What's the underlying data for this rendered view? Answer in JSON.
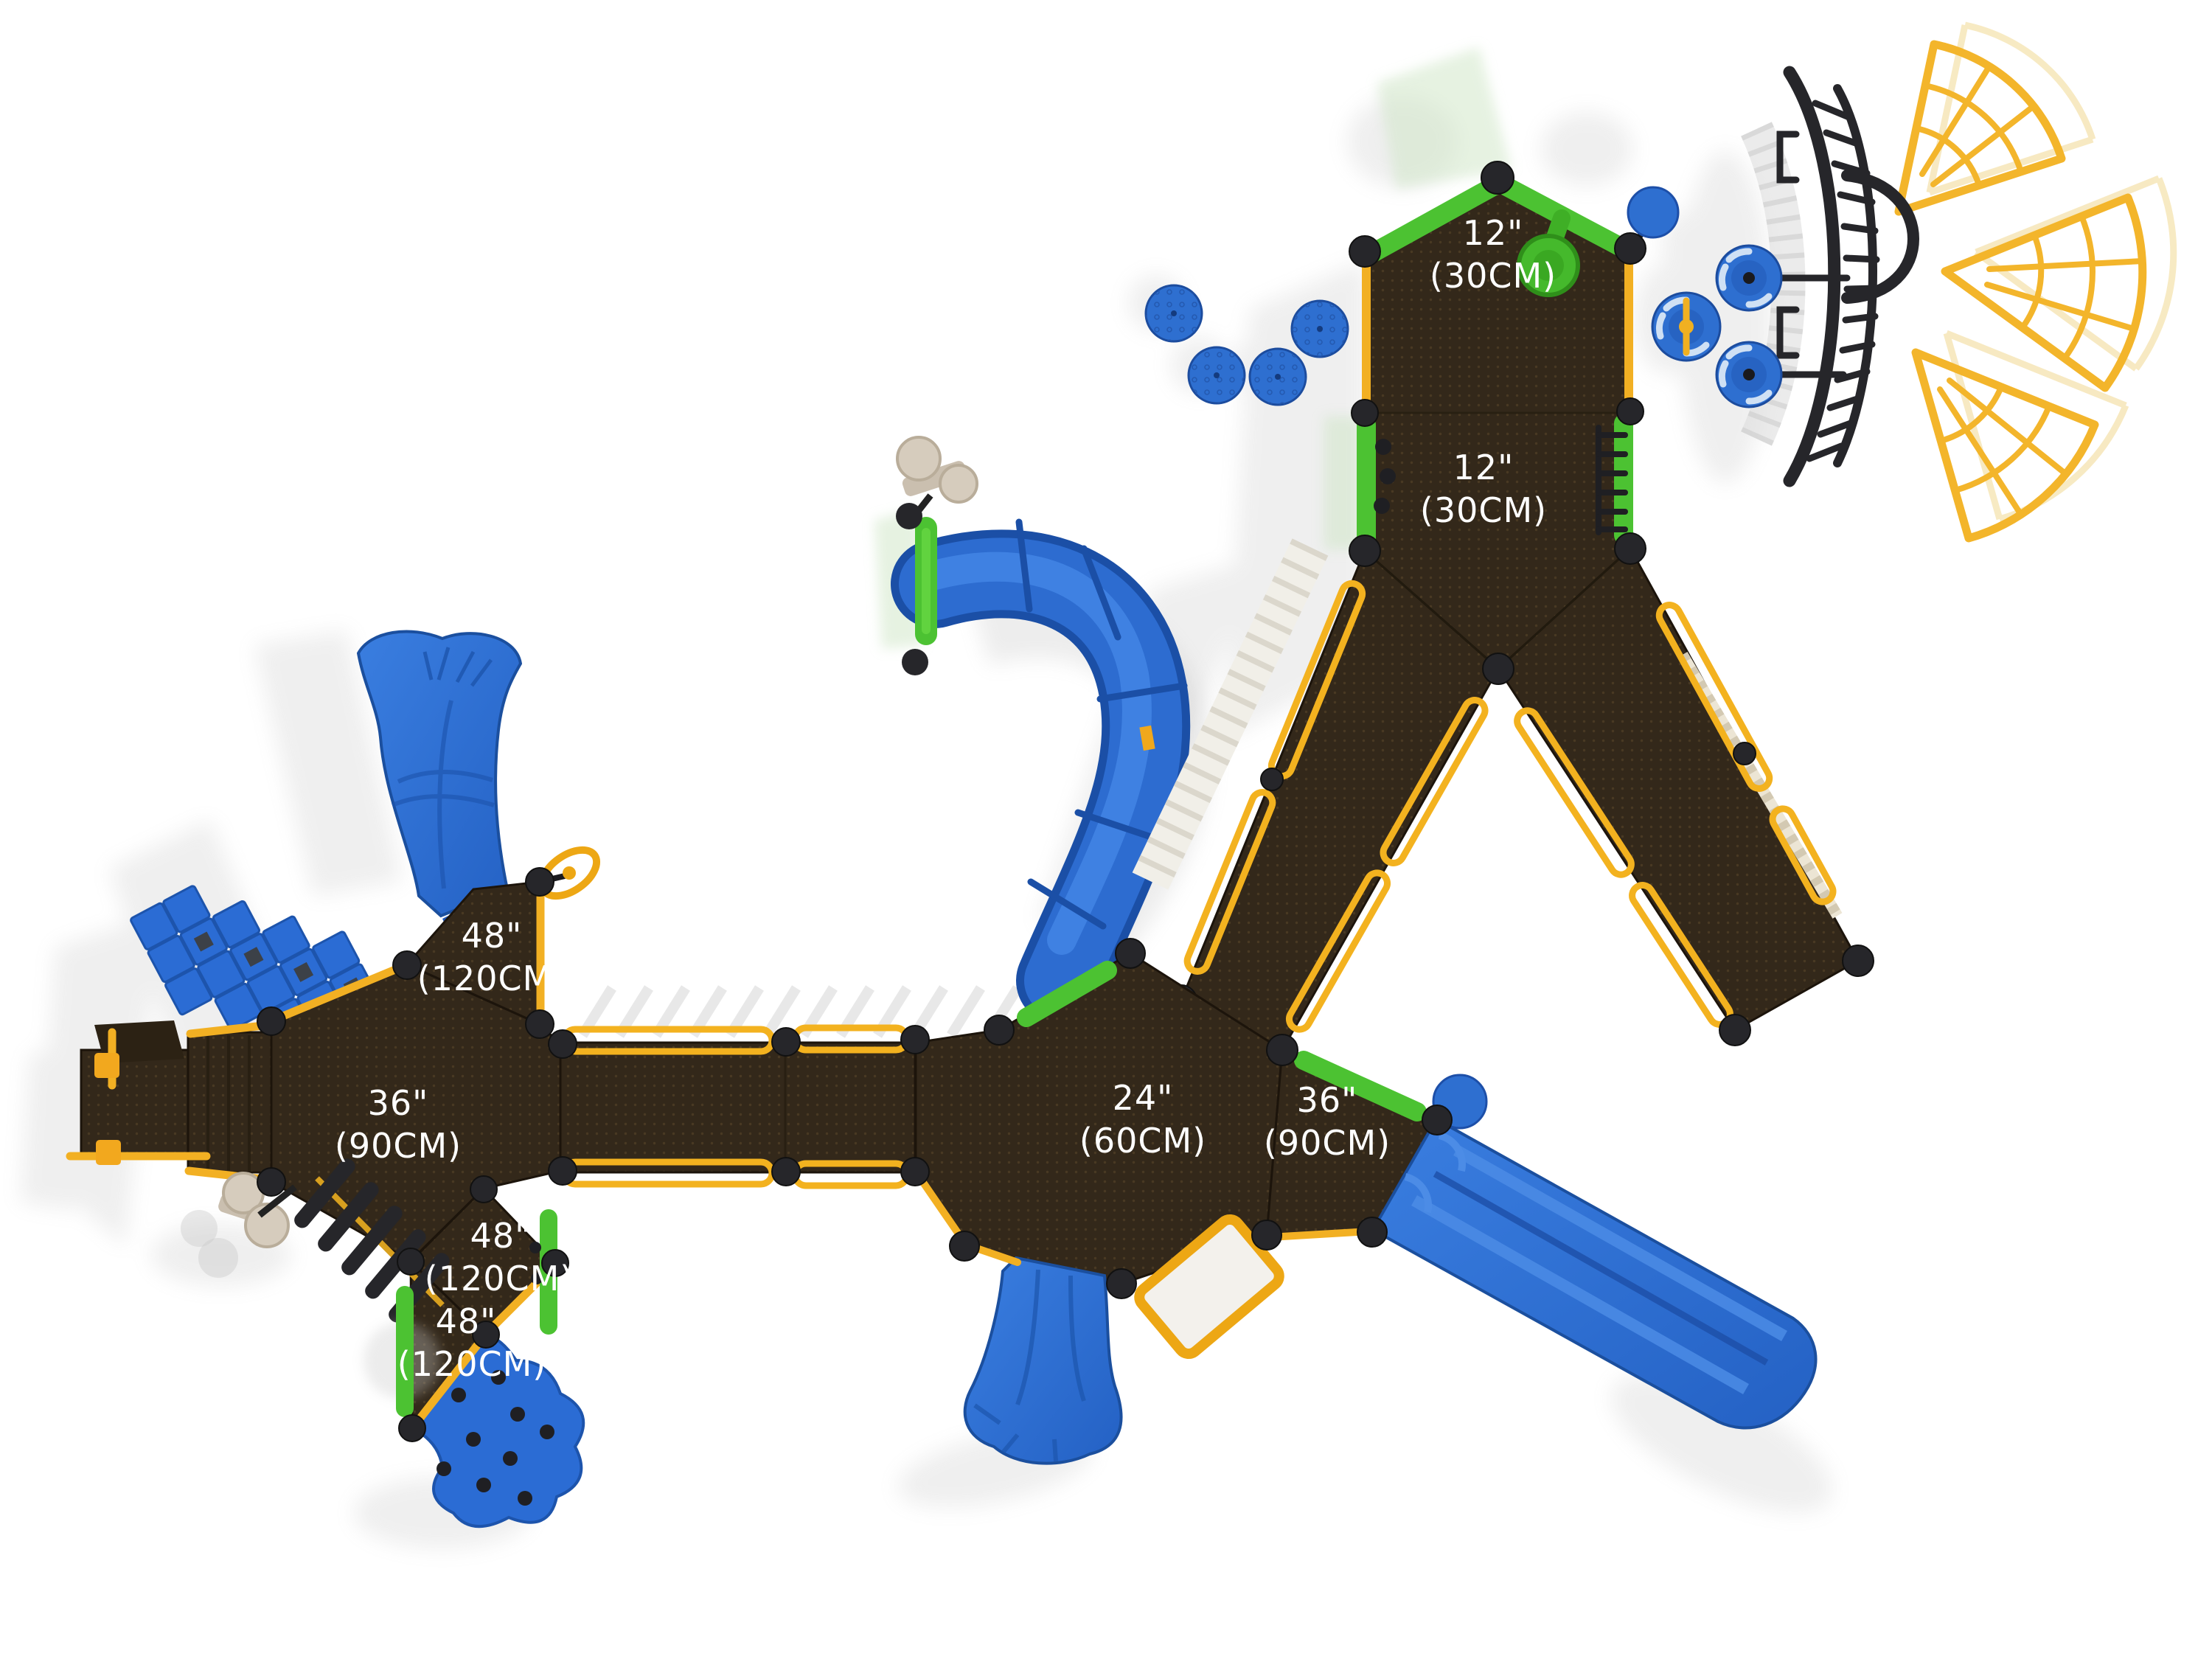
{
  "title": "Playground structure plan view with deck height labels",
  "labels": {
    "deck_top_12": {
      "line1": "12\"",
      "line2": "(30CM)"
    },
    "deck_mid_12": {
      "line1": "12\"",
      "line2": "(30CM)"
    },
    "deck_48_upper": {
      "line1": "48\"",
      "line2": "(120CM)"
    },
    "deck_36_left": {
      "line1": "36\"",
      "line2": "(90CM)"
    },
    "deck_24_center": {
      "line1": "24\"",
      "line2": "(60CM)"
    },
    "deck_36_right": {
      "line1": "36\"",
      "line2": "(90CM)"
    },
    "deck_48_middle": {
      "line1": "48\"",
      "line2": "(120CM)"
    },
    "deck_48_lower": {
      "line1": "48\"",
      "line2": "(120CM)"
    }
  },
  "colors": {
    "deck_brown": "#33281a",
    "deck_dot": "#5a462a",
    "rail_yellow": "#f2b023",
    "accent_green": "#4cc232",
    "slide_blue": "#2d6cd0",
    "slide_blue_dark": "#1b4fa6",
    "structure_black": "#26262a",
    "fan_yellow": "#f3b52b",
    "ghost_gray": "#9b9b9b",
    "beige": "#d6ccbd",
    "label_text": "#ffffff"
  }
}
